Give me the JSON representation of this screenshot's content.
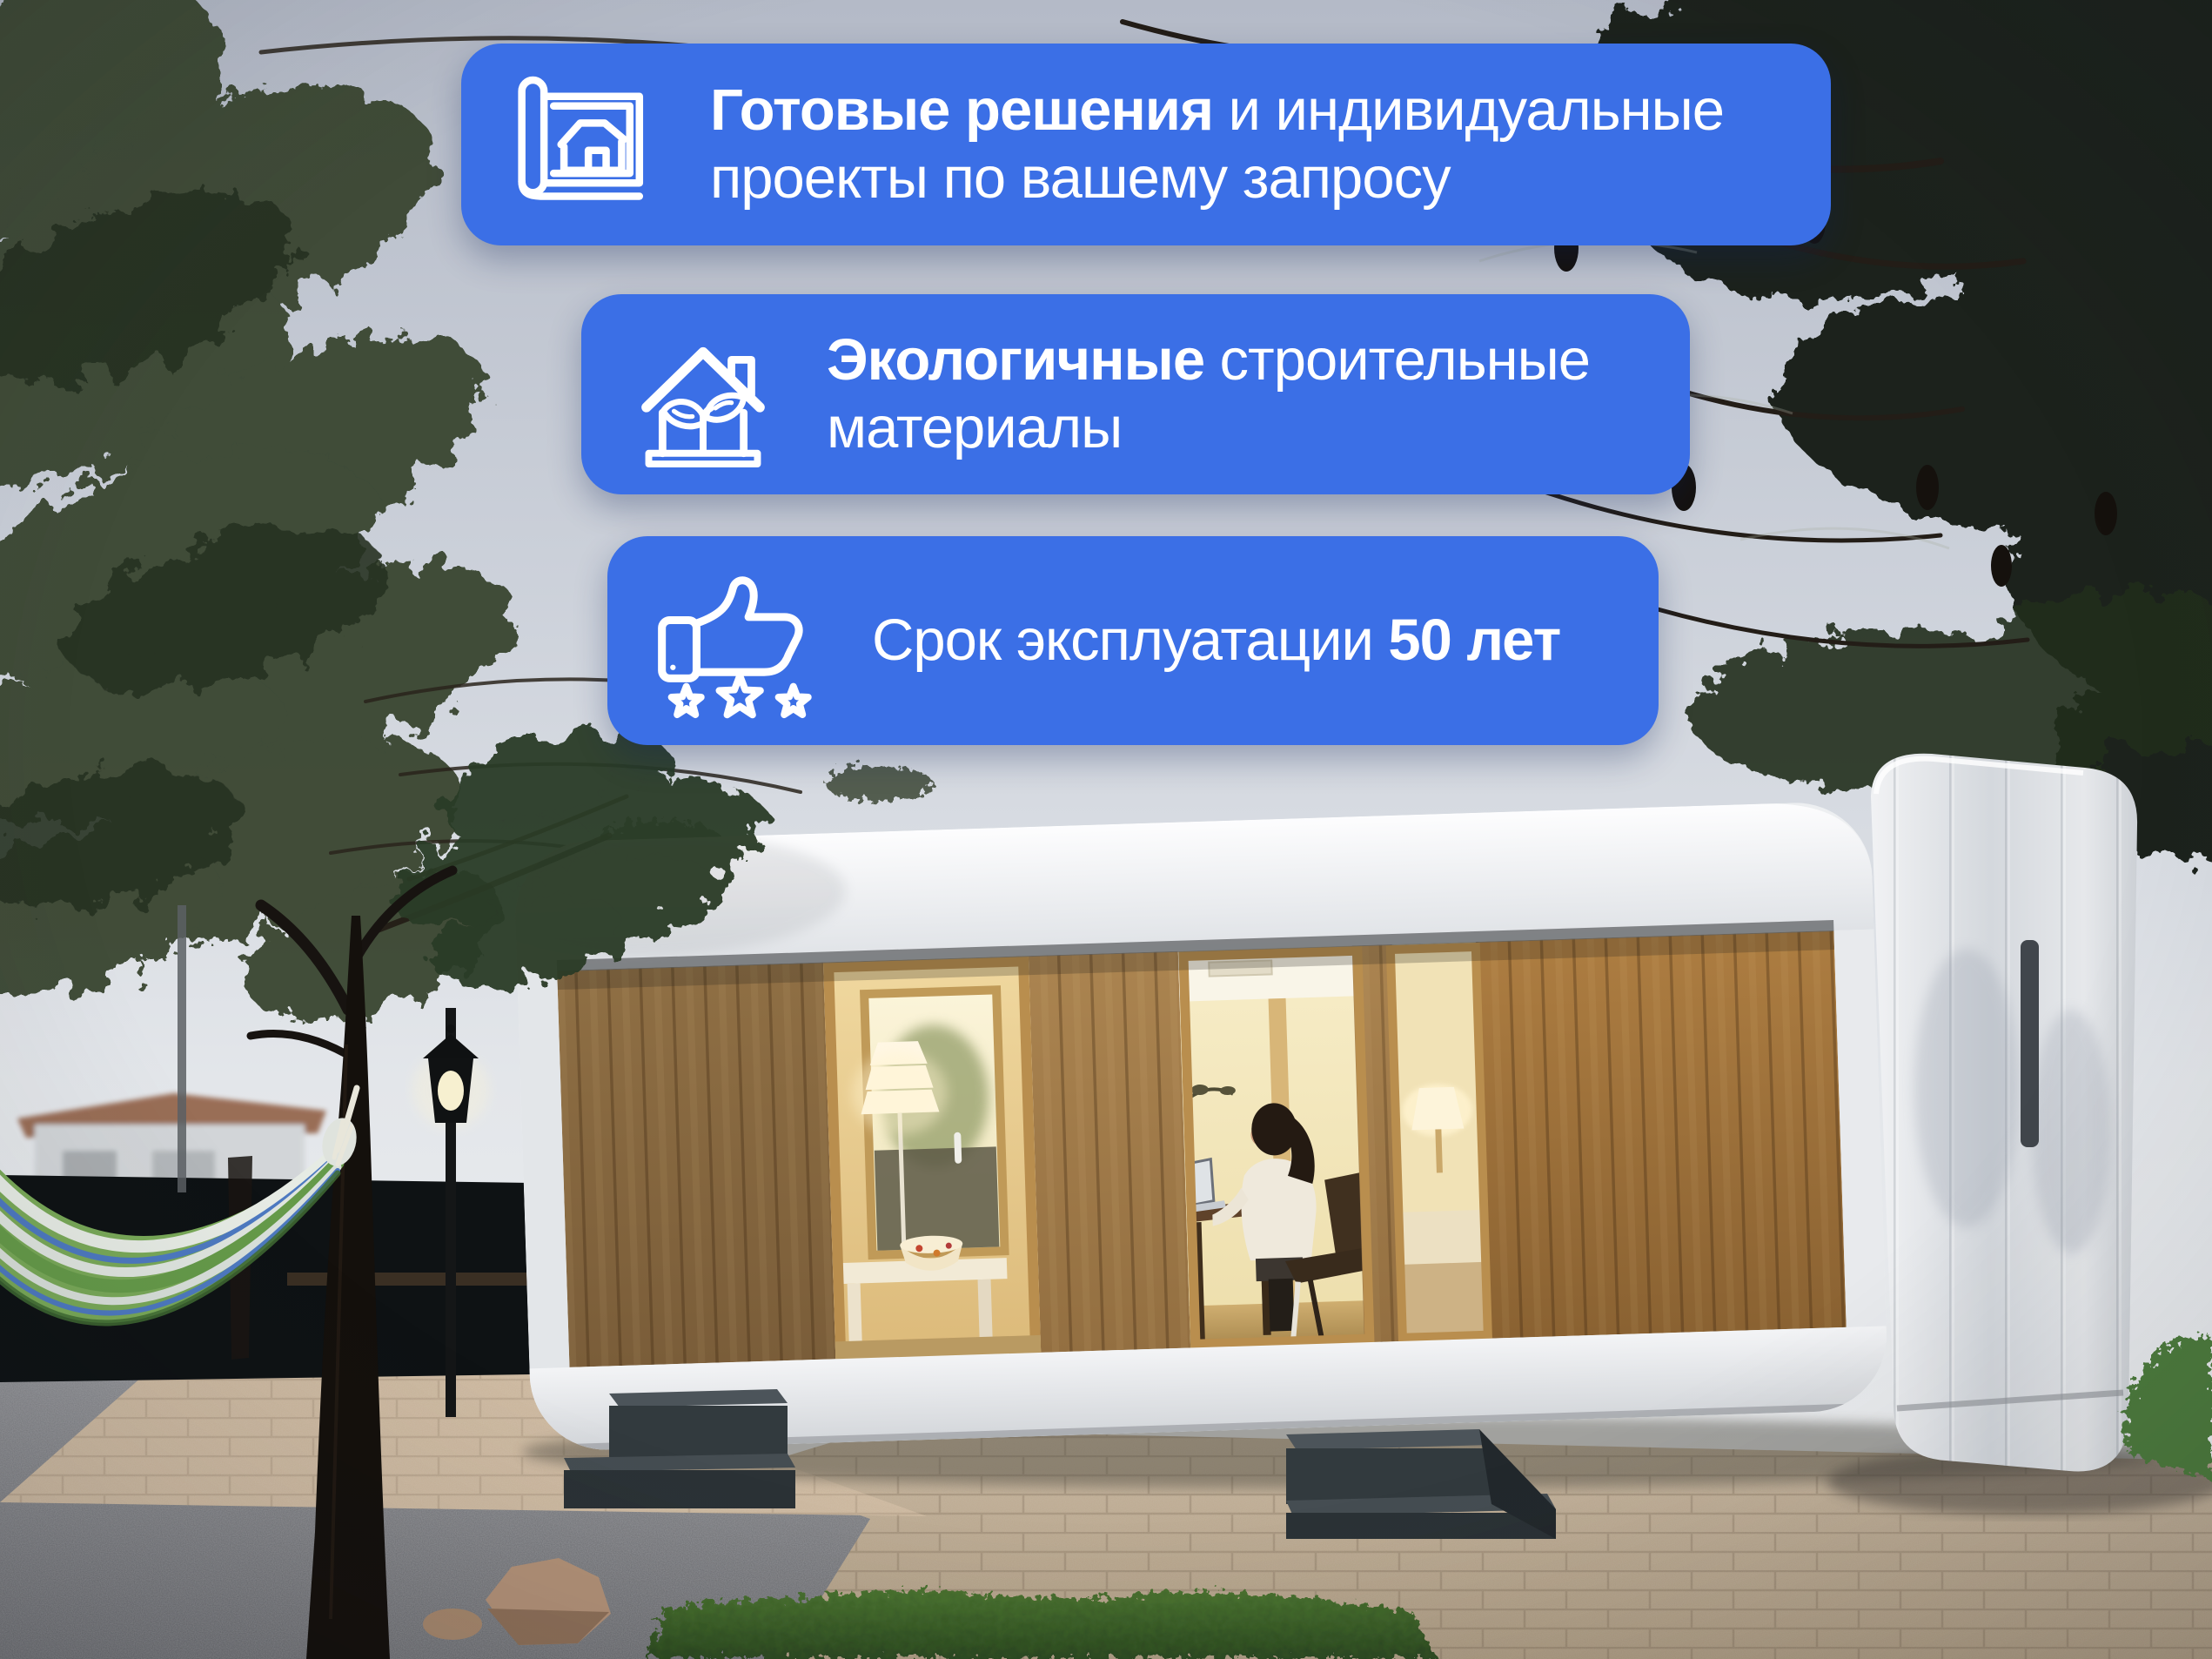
{
  "colors": {
    "banner_blue": "#3B6FE6",
    "banner_text": "#FFFFFF"
  },
  "banners": [
    {
      "icon": "blueprint-house-icon",
      "bold_lead": "Готовые решения",
      "regular_line1": "и индивидуальные",
      "line2": "проекты по вашему запросу"
    },
    {
      "icon": "eco-house-plant-icon",
      "bold_lead": "Экологичные",
      "regular_line1": "строительные",
      "line2": "материалы"
    },
    {
      "icon": "thumbs-up-stars-icon",
      "lead": "Срок эксплуатации",
      "bold_tail": "50 лет"
    }
  ]
}
